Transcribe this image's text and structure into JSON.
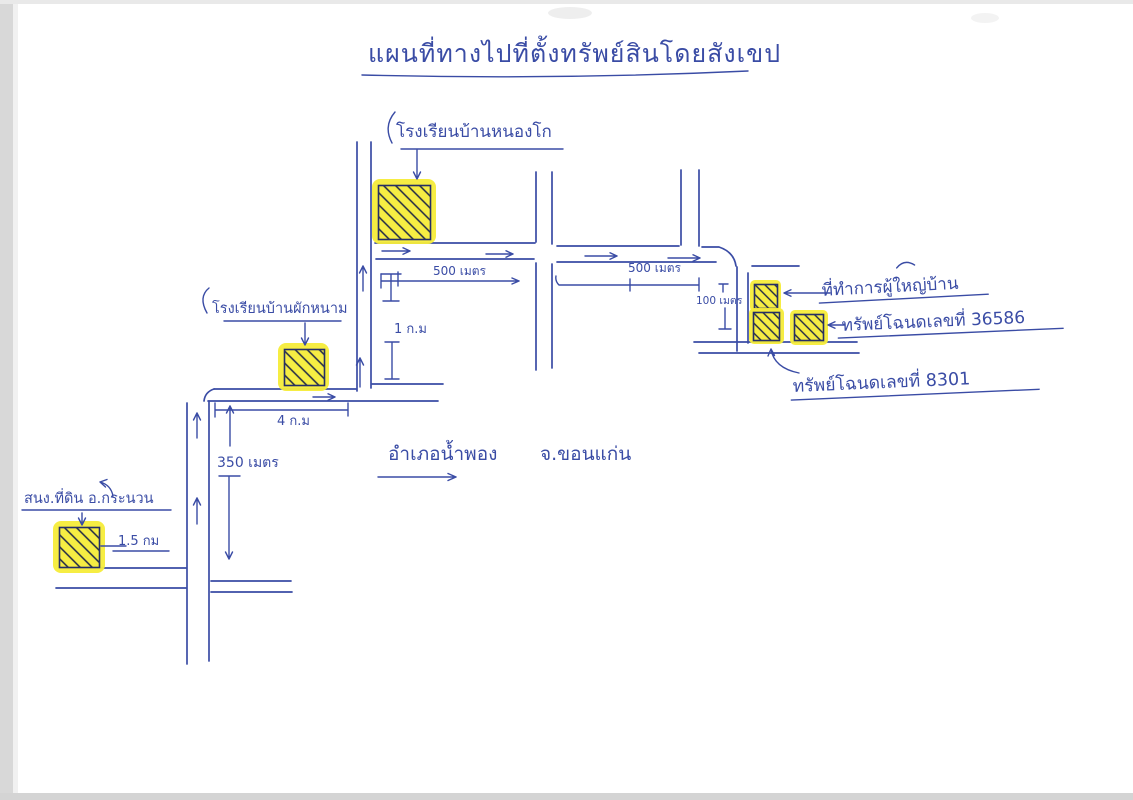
{
  "title": "แผนที่ทางไปที่ตั้งทรัพย์สินโดยสังเขป",
  "places": {
    "school_top": "โรงเรียนบ้านหนองโก",
    "school_left": "โรงเรียนบ้านผักหนาม",
    "village_office": "ที่ทำการผู้ใหญ่บ้าน",
    "deed_36586": "ทรัพย์โฉนดเลขที่ 36586",
    "deed_8301": "ทรัพย์โฉนดเลขที่  8301",
    "land_office": "สนง.ที่ดิน อ.กระนวน",
    "district_amphoe": "อำเภอน้ำพอง",
    "district_province": "จ.ขอนแก่น"
  },
  "distances": {
    "d500_west": "500 เมตร",
    "d500_east": "500 เมตร",
    "d100": "100 เมตร",
    "d1km": "1 ก.ม",
    "d4km": "4 ก.ม",
    "d350": "350 เมตร",
    "d1_5km": "1.5 กม"
  },
  "colors": {
    "ink": "#3a4ca5",
    "hatch": "#1d2546",
    "highlight": "#f6ec39",
    "paper": "#ffffff"
  }
}
